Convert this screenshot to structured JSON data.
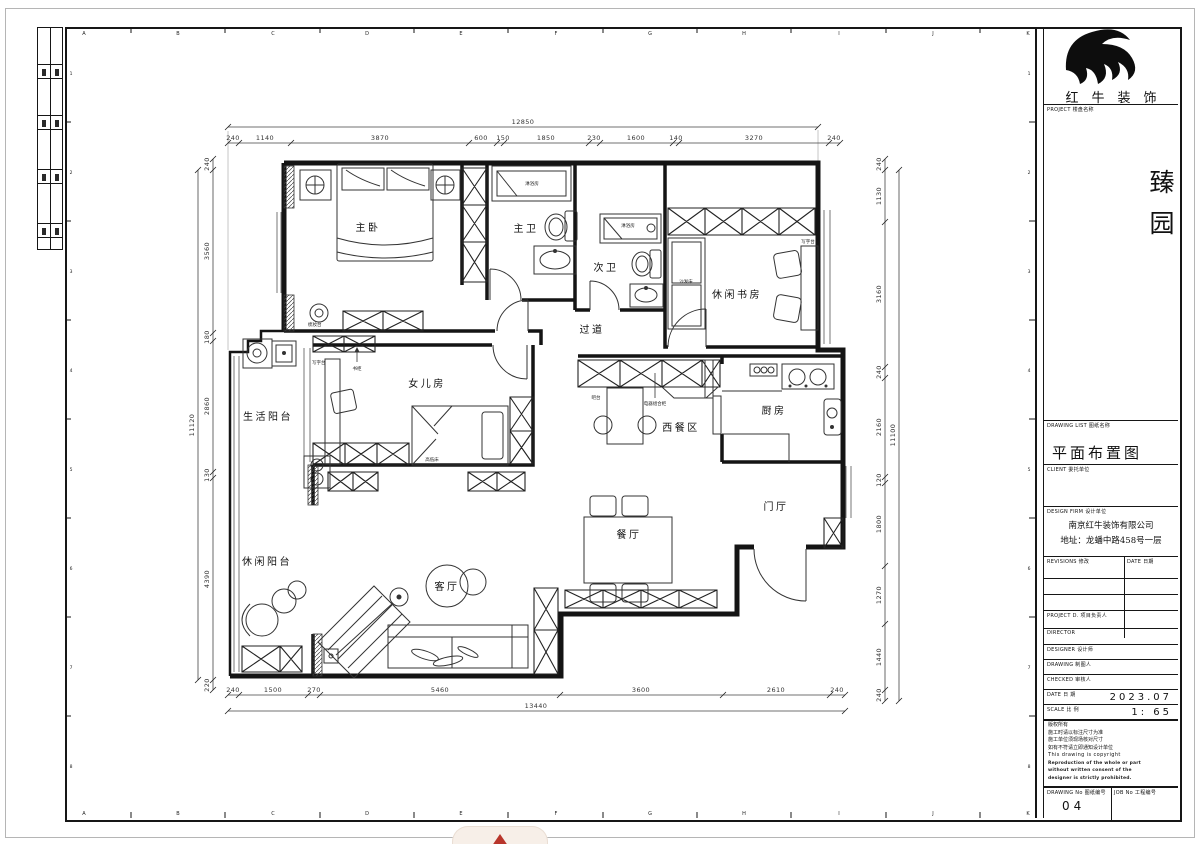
{
  "sheet": {
    "grid": {
      "letters": [
        "A",
        "B",
        "C",
        "D",
        "E",
        "F",
        "G",
        "H",
        "I",
        "J",
        "K"
      ],
      "numbers": [
        "1",
        "2",
        "3",
        "4",
        "5",
        "6",
        "7",
        "8"
      ]
    }
  },
  "title_block": {
    "brand": "红牛装饰",
    "project_label": "PROJECT 楼盘名称",
    "project_name": "臻园",
    "drawing_list_label": "DRAWING LIST 图纸名称",
    "drawing_title": "平面布置图",
    "client_label": "CLIENT 委托单位",
    "design_firm_label": "DESIGN FIRM 设计单位",
    "company": "南京红牛装饰有限公司",
    "address": "地址：龙蟠中路458号一层",
    "revision_label": "REVISIONS 修改",
    "date_col_label": "DATE 日期",
    "staff_rows": [
      {
        "label": "PROJECT D. 项目负责人"
      },
      {
        "label": "DIRECTOR"
      },
      {
        "label": "DESIGNER 设计师"
      },
      {
        "label": "DRAWING 制图人"
      },
      {
        "label": "CHECKED 审核人"
      }
    ],
    "date_label": "DATE 日 期",
    "date_value": "2023.07",
    "scale_label": "SCALE 比 例",
    "scale_value": "1: 65",
    "notes": [
      "版权所有",
      "施工时请以标注尺寸为准",
      "施工单位须现场核对尺寸",
      "如有不符请立即通知设计单位",
      "This drawing is copyright",
      "Reproduction of the whole or part",
      "without written consent of the",
      "designer is strictly prohibited."
    ],
    "drawing_no_label": "DRAWING No 图纸编号",
    "drawing_no": "04",
    "job_no_label": "JOB No 工程编号"
  },
  "plan": {
    "rooms": {
      "master": "主卧",
      "master_bath": "主卫",
      "second_bath": "次卫",
      "study": "休闲书房",
      "corridor": "过道",
      "daughter": "女儿房",
      "service_balcony": "生活阳台",
      "western_dining": "西餐区",
      "kitchen": "厨房",
      "foyer": "门厅",
      "dining": "餐厅",
      "living": "客厅",
      "leisure_balcony": "休闲阳台"
    },
    "furniture": {
      "shower_room_1": "淋浴房",
      "shower_room_2": "淋浴房",
      "dressing_table": "梳妆台",
      "bookcase": "书柜",
      "desk_daughter": "写字台",
      "desk_study": "写字台",
      "sofa_bed": "沙发床",
      "bunk_bed": "高低床",
      "bar_counter": "吧台",
      "appliance_cabinet": "电器组合柜"
    },
    "dims": {
      "top": {
        "total": "12850",
        "segs": [
          "240",
          "1140",
          "3870",
          "600",
          "150",
          "1850",
          "230",
          "1600",
          "140",
          "3270",
          "240"
        ]
      },
      "bottom": {
        "total": "13440",
        "segs": [
          "240",
          "1500",
          "270",
          "5460",
          "3600",
          "2610",
          "240"
        ]
      },
      "left": {
        "total": "11120",
        "segs": [
          "240",
          "3560",
          "180",
          "2860",
          "130",
          "4390",
          "220"
        ]
      },
      "right": {
        "total": "11100",
        "segs": [
          "240",
          "1130",
          "3160",
          "240",
          "2160",
          "120",
          "1800",
          "1270",
          "1440",
          "240"
        ]
      }
    }
  }
}
